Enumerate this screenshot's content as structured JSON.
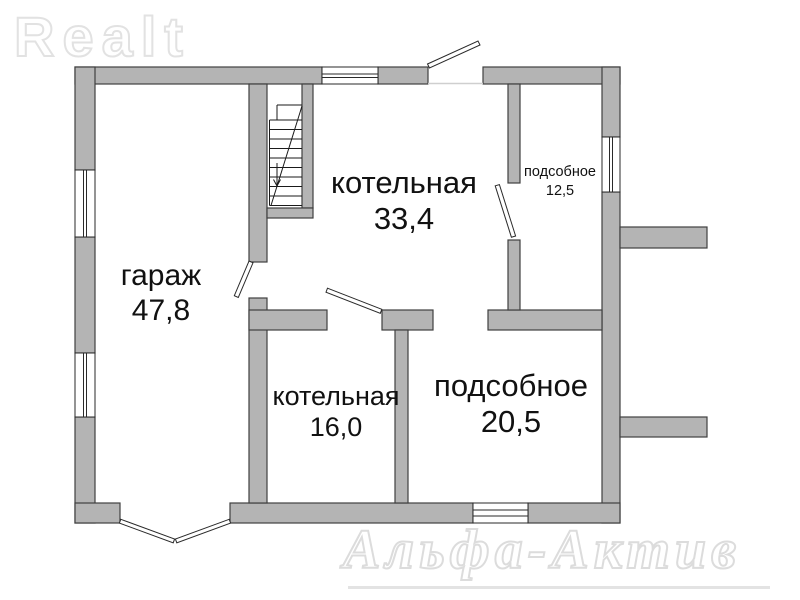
{
  "logo": {
    "text": "Realt"
  },
  "watermark": {
    "text": "Альфа-Актив"
  },
  "rooms": [
    {
      "id": "garage",
      "name": "гараж",
      "area": "47,8"
    },
    {
      "id": "boiler-large",
      "name": "котельная",
      "area": "33,4"
    },
    {
      "id": "utility-small",
      "name": "подсобное",
      "area": "12,5"
    },
    {
      "id": "boiler-small",
      "name": "котельная",
      "area": "16,0"
    },
    {
      "id": "utility-large",
      "name": "подсобное",
      "area": "20,5"
    }
  ],
  "colors": {
    "wall_fill": "#b4b4b4",
    "wall_stroke": "#3f3f3f",
    "line": "#1a1a1a",
    "background": "#ffffff",
    "text": "#111111",
    "watermark": "#e2e2e2"
  }
}
